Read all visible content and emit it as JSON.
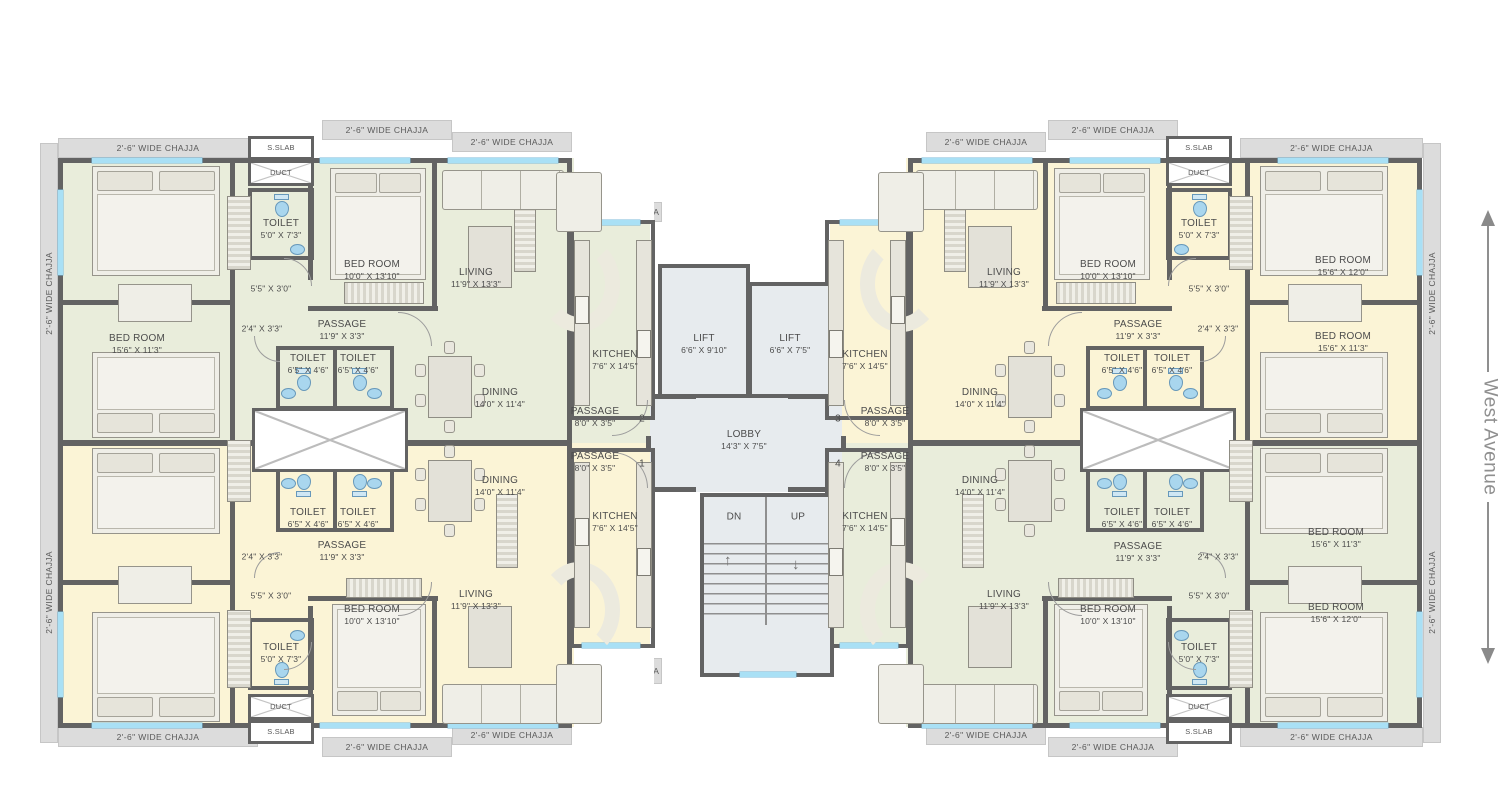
{
  "street_label": "West Avenue",
  "annotations": {
    "chajja": "2'-6\" WIDE CHAJJA",
    "sslab": "S.SLAB",
    "duct": "DUCT",
    "down": "DN",
    "up": "UP"
  },
  "room_types": {
    "bedroom": "BED ROOM",
    "toilet": "TOILET",
    "living": "LIVING",
    "dining": "DINING",
    "kitchen": "KITCHEN",
    "passage": "PASSAGE",
    "lobby": "LOBBY",
    "lift": "LIFT"
  },
  "dimensions": {
    "bedroom_small": "10'0\" X 13'10\"",
    "bedroom_113": "15'6\" X 11'3\"",
    "bedroom_120": "15'6\" X 12'0\"",
    "toilet_small": "6'5\" X 4'6\"",
    "toilet_big": "5'0\" X 7'3\"",
    "living": "11'9\" X 13'3\"",
    "dining": "14'0\" X 11'4\"",
    "kitchen": "7'6\" X 14'5\"",
    "passage_long": "11'9\" X 3'3\"",
    "passage_entry": "8'0\" X 3'5\"",
    "lobby": "14'3\" X 7'5\"",
    "lift_large": "6'6\" X 9'10\"",
    "lift_small": "6'6\" X 7'5\"",
    "niche": "5'5\" X 3'0\"",
    "door_niche": "2'4\" X 3'3\""
  },
  "unit_numbers": [
    "1",
    "2",
    "3",
    "4"
  ],
  "colors": {
    "unit_green": "#e9eddb",
    "unit_yellow": "#fbf4d6",
    "core": "#e7ebee",
    "wall": "#636363",
    "window": "#a9e0f5",
    "chajja_band": "#dcdcdc",
    "street_text": "#8f8f8f",
    "fixture_blue": "#a9d6ee"
  }
}
